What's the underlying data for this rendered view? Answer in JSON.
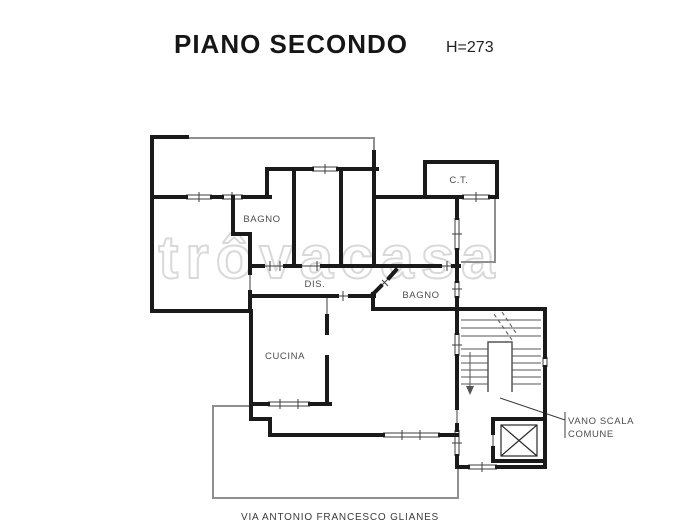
{
  "header": {
    "title": "PIANO SECONDO",
    "height_note": "H=273"
  },
  "footer": {
    "address": "VIA ANTONIO FRANCESCO GLIANES"
  },
  "watermark": "trôvacasa",
  "rooms": {
    "bagno1": "BAGNO",
    "dis": "DIS.",
    "bagno2": "BAGNO",
    "cucina": "CUCINA",
    "ct": "C.T.",
    "vano_scala_line1": "VANO SCALA",
    "vano_scala_line2": "COMUNE"
  },
  "colors": {
    "wall": "#1a1a1a",
    "thin_detail": "#3d3d3d",
    "railing": "#8f8f8f",
    "label": "#4d4d4d",
    "watermark": "#d7d7d7",
    "background": "#ffffff"
  }
}
